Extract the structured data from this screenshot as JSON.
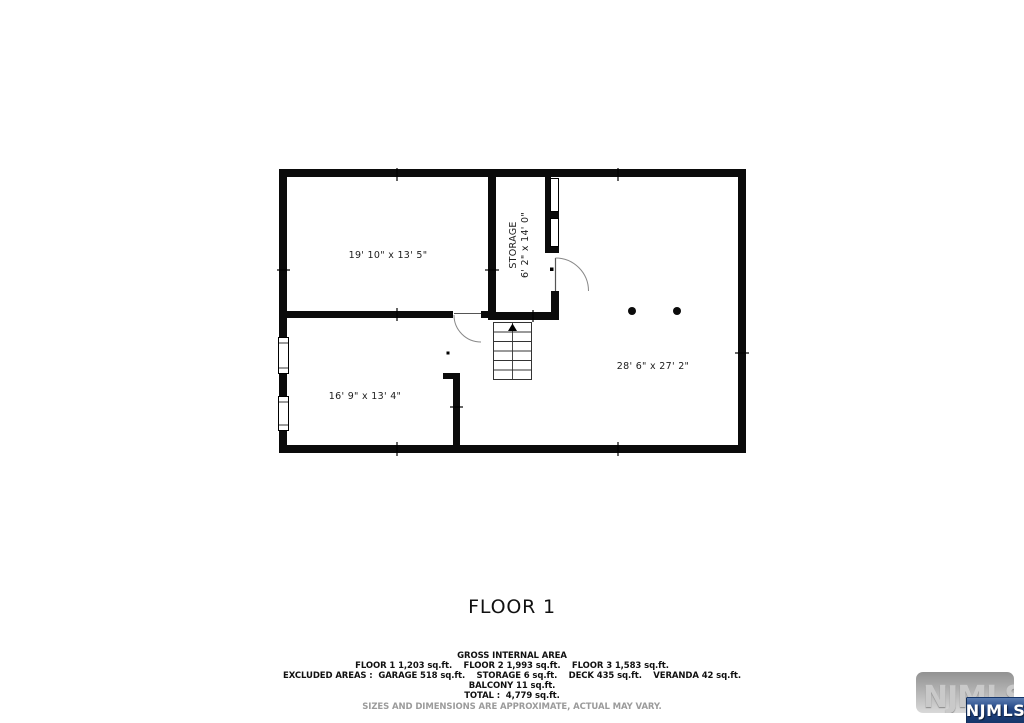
{
  "title": {
    "text": "FLOOR 1"
  },
  "floor_plan": {
    "rooms": [
      {
        "id": "top-left-room",
        "dimensions": "19' 10\" x 13' 5\""
      },
      {
        "id": "storage",
        "label": "STORAGE",
        "dimensions": "6' 2\" x 14' 0\""
      },
      {
        "id": "bottom-left-room",
        "dimensions": "16' 9\" x 13' 4\""
      },
      {
        "id": "right-room",
        "dimensions": "28' 6\" x 27' 2\""
      }
    ],
    "wall_color": "#0b0b0b",
    "column_dots": 2,
    "stair_direction": "up"
  },
  "summary": {
    "heading": "GROSS INTERNAL AREA",
    "line_floors": "FLOOR 1 1,203 sq.ft.    FLOOR 2 1,993 sq.ft.    FLOOR 3 1,583 sq.ft.",
    "line_excluded": "EXCLUDED AREAS :  GARAGE 518 sq.ft.    STORAGE 6 sq.ft.    DECK 435 sq.ft.    VERANDA 42 sq.ft.",
    "line_balcony": "BALCONY 11 sq.ft.",
    "line_total": "TOTAL :  4,779 sq.ft.",
    "disclaimer": "SIZES AND DIMENSIONS ARE APPROXIMATE, ACTUAL MAY VARY."
  },
  "watermark": {
    "background_text": "NJMLS",
    "badge_text": "NJMLS",
    "badge_color": "#1f4280",
    "gray_box_color": "#b5b5b5"
  }
}
